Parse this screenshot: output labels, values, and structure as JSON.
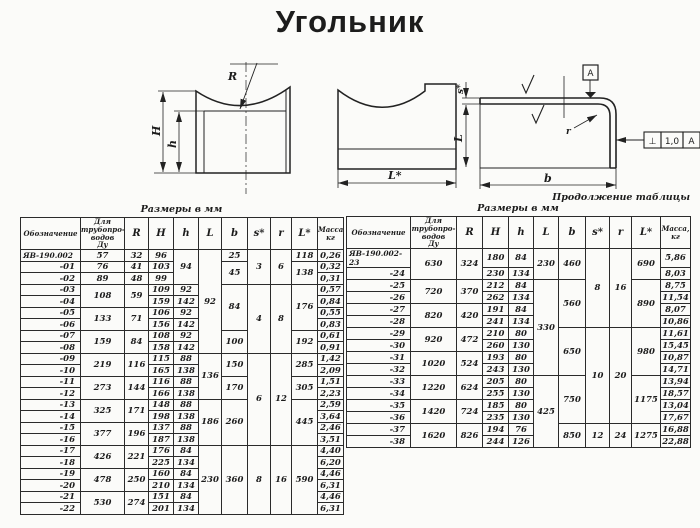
{
  "title": "Угольник",
  "drawings": {
    "front": {
      "labels": {
        "H": "H",
        "h": "h",
        "R": "R"
      }
    },
    "profile": {
      "labels": {
        "L_star": "L*"
      }
    },
    "section": {
      "labels": {
        "s_star": "s*",
        "L": "L",
        "b": "b",
        "r": "r"
      },
      "datum_label": "А",
      "tolerance_frame": {
        "symbol": "⊥",
        "value": "1,0",
        "datum": "А"
      }
    }
  },
  "table_main": {
    "caption": "Размеры в мм",
    "headers": [
      "Обозначение",
      "Для\nтрубопро-\nводов\nДу",
      "R",
      "H",
      "h",
      "L",
      "b",
      "s*",
      "r",
      "L*",
      "Масса,\nкг"
    ],
    "rows": [
      [
        "ЯВ-190.002",
        "57",
        "32",
        "96",
        [
          "94",
          3
        ],
        [
          "92",
          9
        ],
        "25",
        [
          "3",
          3
        ],
        [
          "6",
          3
        ],
        "118",
        "0,26"
      ],
      [
        "-01",
        "76",
        "41",
        "103",
        null,
        null,
        [
          "45",
          2
        ],
        null,
        null,
        [
          "138",
          2
        ],
        "0,32"
      ],
      [
        "-02",
        "89",
        "48",
        "99",
        null,
        null,
        null,
        null,
        null,
        null,
        "0,31"
      ],
      [
        "-03",
        [
          "108",
          2
        ],
        [
          "59",
          2
        ],
        "109",
        "92",
        null,
        [
          "84",
          4
        ],
        [
          "4",
          6
        ],
        [
          "8",
          6
        ],
        [
          "176",
          4
        ],
        "0,57"
      ],
      [
        "-04",
        null,
        null,
        "159",
        "142",
        null,
        null,
        null,
        null,
        null,
        "0,84"
      ],
      [
        "-05",
        [
          "133",
          2
        ],
        [
          "71",
          2
        ],
        "106",
        "92",
        null,
        null,
        null,
        null,
        null,
        "0,55"
      ],
      [
        "-06",
        null,
        null,
        "156",
        "142",
        null,
        null,
        null,
        null,
        null,
        "0,83"
      ],
      [
        "-07",
        [
          "159",
          2
        ],
        [
          "84",
          2
        ],
        "108",
        "92",
        null,
        [
          "100",
          2
        ],
        null,
        null,
        [
          "192",
          2
        ],
        "0,61"
      ],
      [
        "-08",
        null,
        null,
        "158",
        "142",
        null,
        null,
        null,
        null,
        null,
        "0,91"
      ],
      [
        "-09",
        [
          "219",
          2
        ],
        [
          "116",
          2
        ],
        "115",
        "88",
        [
          "136",
          4
        ],
        [
          "150",
          2
        ],
        [
          "6",
          8
        ],
        [
          "12",
          8
        ],
        [
          "285",
          2
        ],
        "1,42"
      ],
      [
        "-10",
        null,
        null,
        "165",
        "138",
        null,
        null,
        null,
        null,
        null,
        "2,09"
      ],
      [
        "-11",
        [
          "273",
          2
        ],
        [
          "144",
          2
        ],
        "116",
        "88",
        null,
        [
          "170",
          2
        ],
        null,
        null,
        [
          "305",
          2
        ],
        "1,51"
      ],
      [
        "-12",
        null,
        null,
        "166",
        "138",
        null,
        null,
        null,
        null,
        null,
        "2,23"
      ],
      [
        "-13",
        [
          "325",
          2
        ],
        [
          "171",
          2
        ],
        "148",
        "88",
        [
          "186",
          4
        ],
        [
          "260",
          4
        ],
        null,
        null,
        [
          "445",
          4
        ],
        "2,59"
      ],
      [
        "-14",
        null,
        null,
        "198",
        "138",
        null,
        null,
        null,
        null,
        null,
        "3,64"
      ],
      [
        "-15",
        [
          "377",
          2
        ],
        [
          "196",
          2
        ],
        "137",
        "88",
        null,
        null,
        null,
        null,
        null,
        "2,46"
      ],
      [
        "-16",
        null,
        null,
        "187",
        "138",
        null,
        null,
        null,
        null,
        null,
        "3,51"
      ],
      [
        "-17",
        [
          "426",
          2
        ],
        [
          "221",
          2
        ],
        "176",
        "84",
        [
          "230",
          6
        ],
        [
          "360",
          6
        ],
        [
          "8",
          6
        ],
        [
          "16",
          6
        ],
        [
          "590",
          6
        ],
        "4,40"
      ],
      [
        "-18",
        null,
        null,
        "225",
        "134",
        null,
        null,
        null,
        null,
        null,
        "6,20"
      ],
      [
        "-19",
        [
          "478",
          2
        ],
        [
          "250",
          2
        ],
        "160",
        "84",
        null,
        null,
        null,
        null,
        null,
        "4,46"
      ],
      [
        "-20",
        null,
        null,
        "210",
        "134",
        null,
        null,
        null,
        null,
        null,
        "6,31"
      ],
      [
        "-21",
        [
          "530",
          2
        ],
        [
          "274",
          2
        ],
        "151",
        "84",
        null,
        null,
        null,
        null,
        null,
        "4,46"
      ],
      [
        "-22",
        null,
        null,
        "201",
        "134",
        null,
        null,
        null,
        null,
        null,
        "6,31"
      ]
    ]
  },
  "table_cont": {
    "continuation_label": "Продолжение таблицы",
    "caption": "Размеры в мм",
    "headers": [
      "Обозначение",
      "Для\nтрубопро-\nводов\nДу",
      "R",
      "H",
      "h",
      "L",
      "b",
      "s*",
      "r",
      "L*",
      "Масса,\nкг"
    ],
    "rows": [
      [
        "ЯВ-190.002-23",
        [
          "630",
          2
        ],
        [
          "324",
          2
        ],
        "180",
        "84",
        [
          "230",
          2
        ],
        [
          "460",
          2
        ],
        [
          "8",
          6
        ],
        [
          "16",
          6
        ],
        [
          "690",
          2
        ],
        "5,86"
      ],
      [
        "-24",
        null,
        null,
        "230",
        "134",
        null,
        null,
        null,
        null,
        null,
        "8,03"
      ],
      [
        "-25",
        [
          "720",
          2
        ],
        [
          "370",
          2
        ],
        "212",
        "84",
        [
          "330",
          8
        ],
        [
          "560",
          4
        ],
        null,
        null,
        [
          "890",
          4
        ],
        "8,75"
      ],
      [
        "-26",
        null,
        null,
        "262",
        "134",
        null,
        null,
        null,
        null,
        null,
        "11,54"
      ],
      [
        "-27",
        [
          "820",
          2
        ],
        [
          "420",
          2
        ],
        "191",
        "84",
        null,
        null,
        null,
        null,
        null,
        "8,07"
      ],
      [
        "-28",
        null,
        null,
        "241",
        "134",
        null,
        null,
        null,
        null,
        null,
        "10,86"
      ],
      [
        "-29",
        [
          "920",
          2
        ],
        [
          "472",
          2
        ],
        "210",
        "80",
        null,
        [
          "650",
          4
        ],
        [
          "10",
          8
        ],
        [
          "20",
          8
        ],
        [
          "980",
          4
        ],
        "11,61"
      ],
      [
        "-30",
        null,
        null,
        "260",
        "130",
        null,
        null,
        null,
        null,
        null,
        "15,45"
      ],
      [
        "-31",
        [
          "1020",
          2
        ],
        [
          "524",
          2
        ],
        "193",
        "80",
        null,
        null,
        null,
        null,
        null,
        "10,87"
      ],
      [
        "-32",
        null,
        null,
        "243",
        "130",
        null,
        null,
        null,
        null,
        null,
        "14,71"
      ],
      [
        "-33",
        [
          "1220",
          2
        ],
        [
          "624",
          2
        ],
        "205",
        "80",
        [
          "425",
          6
        ],
        [
          "750",
          4
        ],
        null,
        null,
        [
          "1175",
          4
        ],
        "13,94"
      ],
      [
        "-34",
        null,
        null,
        "255",
        "130",
        null,
        null,
        null,
        null,
        null,
        "18,57"
      ],
      [
        "-35",
        [
          "1420",
          2
        ],
        [
          "724",
          2
        ],
        "185",
        "80",
        null,
        null,
        null,
        null,
        null,
        "13,04"
      ],
      [
        "-36",
        null,
        null,
        "235",
        "130",
        null,
        null,
        null,
        null,
        null,
        "17,67"
      ],
      [
        "-37",
        [
          "1620",
          2
        ],
        [
          "826",
          2
        ],
        "194",
        "76",
        null,
        [
          "850",
          2
        ],
        [
          "12",
          2
        ],
        [
          "24",
          2
        ],
        [
          "1275",
          2
        ],
        "16,88"
      ],
      [
        "-38",
        null,
        null,
        "244",
        "126",
        null,
        null,
        null,
        null,
        null,
        "22,88"
      ]
    ]
  }
}
